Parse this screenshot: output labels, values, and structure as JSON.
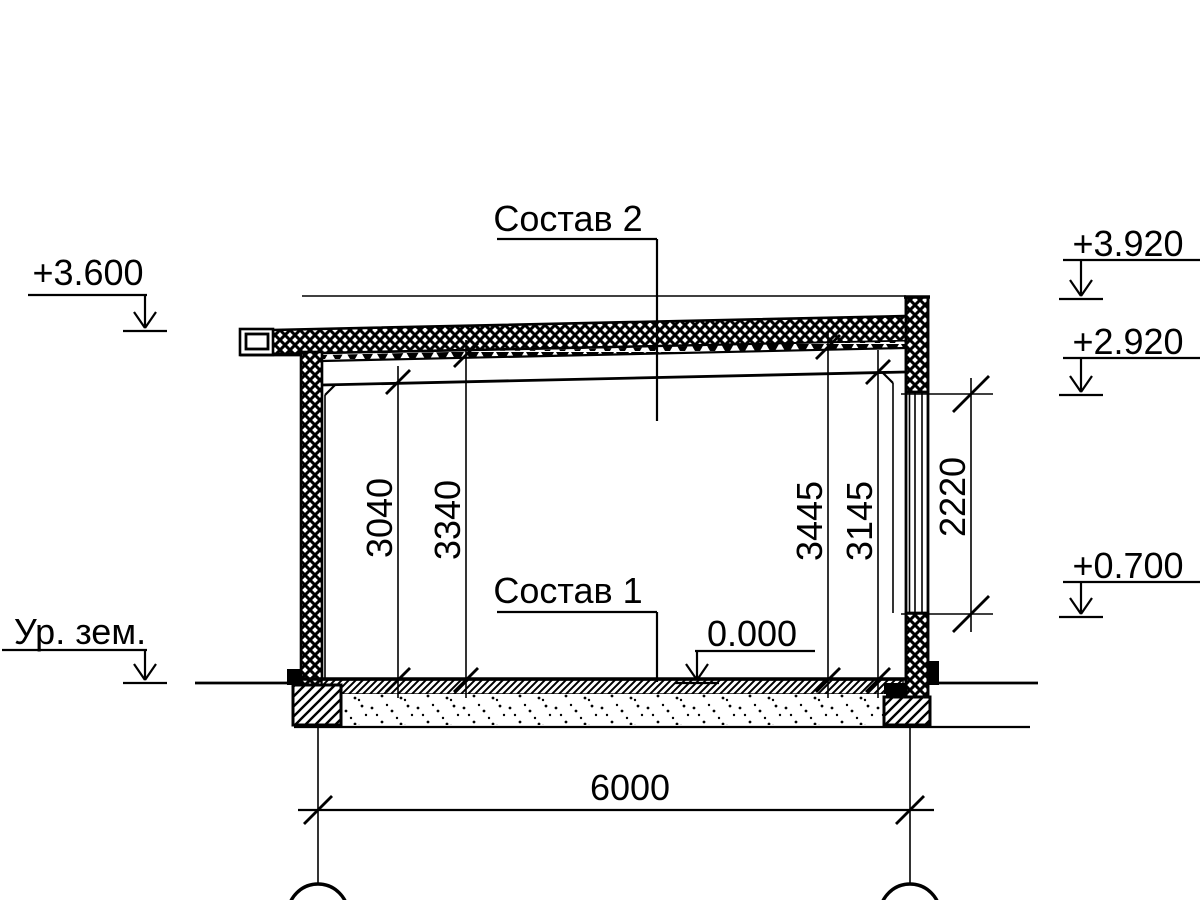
{
  "drawing": {
    "callouts": {
      "roof": "Состав 2",
      "floor": "Состав 1"
    },
    "elevation_marks": {
      "eave_left": "+3.600",
      "parapet_right": "+3.920",
      "window_head_right": "+2.920",
      "window_sill_right": "+0.700",
      "ground_level": "Ур. зем.",
      "floor_zero": "0.000"
    },
    "dimensions": {
      "interior_heights": [
        {
          "label": "3040"
        },
        {
          "label": "3340"
        },
        {
          "label": "3445"
        },
        {
          "label": "3145"
        }
      ],
      "window_height": "2220",
      "span_width": "6000"
    },
    "colors": {
      "ink": "#000000",
      "paper": "#ffffff"
    }
  }
}
